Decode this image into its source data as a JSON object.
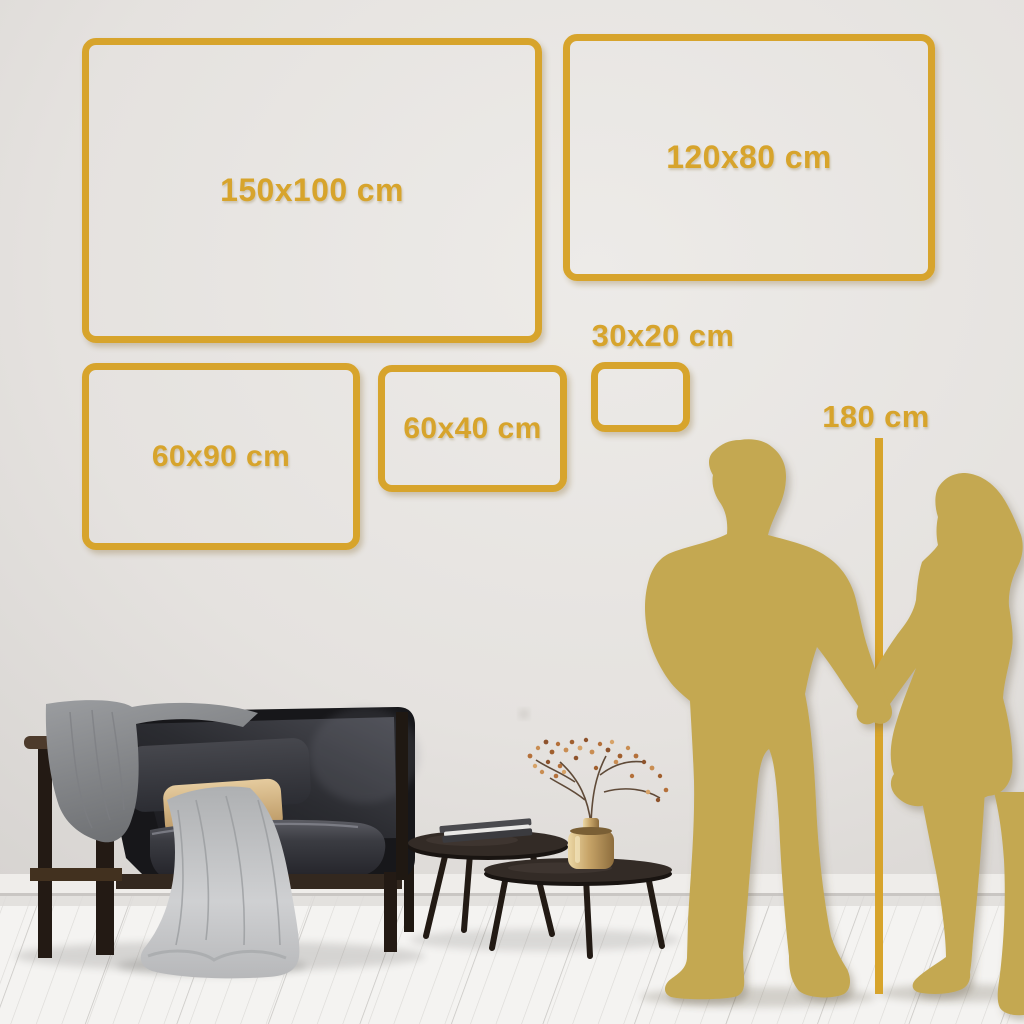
{
  "size_guide": {
    "frames": [
      {
        "id": "150x100",
        "label": "150x100 cm"
      },
      {
        "id": "120x80",
        "label": "120x80 cm"
      },
      {
        "id": "30x20",
        "label": "30x20 cm"
      },
      {
        "id": "60x40",
        "label": "60x40 cm"
      },
      {
        "id": "60x90",
        "label": "60x90 cm"
      }
    ],
    "height_marker": {
      "label": "180 cm"
    }
  },
  "colors": {
    "gold_accent": "#D7A42C",
    "gold_silhouette": "#C4A851",
    "wall": "#E6E3E0",
    "floor": "#F4F3F1"
  },
  "scene": {
    "objects": [
      "sofa",
      "gray-blanket",
      "dark-cushion",
      "beige-cushion",
      "nesting-coffee-tables",
      "books",
      "brass-vase-with-dried-plant",
      "man-silhouette",
      "woman-silhouette",
      "height-measure-line"
    ]
  }
}
